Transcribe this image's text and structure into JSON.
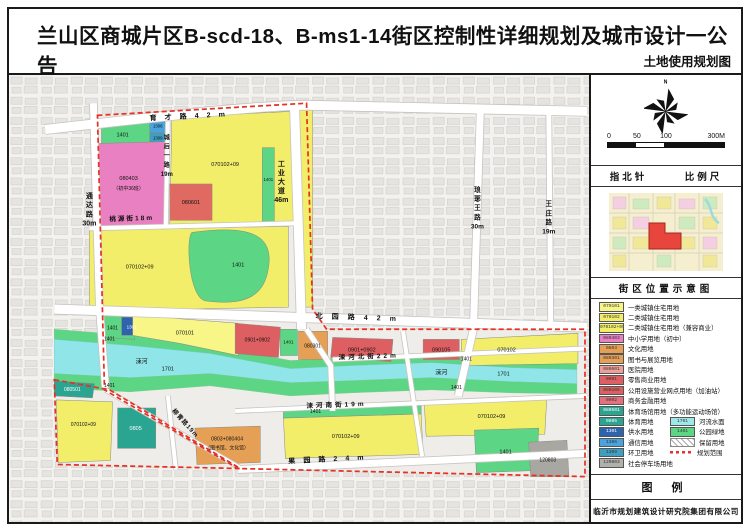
{
  "header": {
    "title": "兰山区商城片区B-scd-18、B-ms1-14街区控制性详细规划及城市设计一公告",
    "subtitle": "土地使用规划图"
  },
  "sidebar": {
    "north_label": "N",
    "scale_ticks": [
      "0",
      "50",
      "100",
      "300M"
    ],
    "captions": {
      "compass": "指北针",
      "scale": "比例尺",
      "location": "街区位置示意图",
      "legend": "图 例"
    },
    "company": "临沂市规划建筑设计研究院集团有限公司",
    "legend": {
      "single": [
        {
          "code": "070101",
          "label": "一类城镇住宅用地",
          "color": "#f8f686"
        },
        {
          "code": "070102",
          "label": "二类城镇住宅用地",
          "color": "#f2ee6a"
        },
        {
          "code": "070102+09",
          "label": "二类城镇住宅用地（兼容商业）",
          "color": "#f2ee6a"
        },
        {
          "code": "080403",
          "label": "中小学用地（初中）",
          "color": "#e980c1"
        },
        {
          "code": "0803",
          "label": "文化用地",
          "color": "#e5a055"
        },
        {
          "code": "080301",
          "label": "图书与展览用地",
          "color": "#e5a055"
        },
        {
          "code": "080601",
          "label": "医院用地",
          "color": "#eda09a"
        },
        {
          "code": "0901",
          "label": "零售商业用地",
          "color": "#dd5f62"
        },
        {
          "code": "090105",
          "label": "公用设施营业网点用地（加油站）",
          "color": "#dd5f62"
        },
        {
          "code": "0902",
          "label": "商务金融用地",
          "color": "#e4707d"
        },
        {
          "code": "080501",
          "label": "体育场馆用地（多功能运动场馆）",
          "color": "#2aa592"
        }
      ],
      "left_col": [
        {
          "code": "0805",
          "label": "体育用地",
          "color": "#2aa592"
        },
        {
          "code": "1301",
          "label": "供水用地",
          "color": "#2f64ad"
        },
        {
          "code": "1306",
          "label": "通信用地",
          "color": "#4aa3dc"
        },
        {
          "code": "1309",
          "label": "环卫用地",
          "color": "#3f9fc0"
        }
      ],
      "right_col": [
        {
          "code": "1701",
          "label": "河流水面",
          "color": "#9fe8ea"
        },
        {
          "code": "1401",
          "label": "公园绿地",
          "color": "#5cd584"
        },
        {
          "code": "",
          "label": "保留用地",
          "type": "hatch"
        },
        {
          "code": "",
          "label": "规划范围",
          "type": "boundary"
        }
      ],
      "last": {
        "code": "120803",
        "label": "社会停车场用地",
        "color": "#b2b0ab"
      }
    }
  },
  "map": {
    "labels": [
      {
        "text": "育才路42m"
      },
      {
        "text": "通达路30m"
      },
      {
        "text": "城后一路19m"
      },
      {
        "text": "桃源街18m"
      },
      {
        "text": "工业大道46m"
      },
      {
        "text": "琅琊王路30m"
      },
      {
        "text": "王庄路19m"
      },
      {
        "text": "北园路42m"
      },
      {
        "text": "涑河北街22m"
      },
      {
        "text": "涑河南街19m"
      },
      {
        "text": "果园路24m"
      },
      {
        "text": "柳青路19m"
      },
      {
        "text": "1401"
      },
      {
        "text": "1306"
      },
      {
        "text": "1309"
      },
      {
        "text": "080403"
      },
      {
        "text": "（初中36班）"
      },
      {
        "text": "070102+09"
      },
      {
        "text": "080601"
      },
      {
        "text": "070102+09"
      },
      {
        "text": "1401"
      },
      {
        "text": "1401"
      },
      {
        "text": "1401"
      },
      {
        "text": "1301"
      },
      {
        "text": "070101"
      },
      {
        "text": "0901+0902"
      },
      {
        "text": "1401"
      },
      {
        "text": "080301"
      },
      {
        "text": "0901+0902"
      },
      {
        "text": "090105"
      },
      {
        "text": "070102"
      },
      {
        "text": "涑河"
      },
      {
        "text": "1701"
      },
      {
        "text": "1401"
      },
      {
        "text": "1401"
      },
      {
        "text": "涑河"
      },
      {
        "text": "1701"
      },
      {
        "text": "1401"
      },
      {
        "text": "1401"
      },
      {
        "text": "1401"
      },
      {
        "text": "080501"
      },
      {
        "text": "070102+09"
      },
      {
        "text": "0805"
      },
      {
        "text": "0803+080404"
      },
      {
        "text": "（图书馆、文化馆）"
      },
      {
        "text": "070102+09"
      },
      {
        "text": "070102+09"
      },
      {
        "text": "1401"
      },
      {
        "text": "120803"
      }
    ]
  },
  "colors": {
    "yellow": "#f2ee6a",
    "yellow-light": "#f8f686",
    "pink": "#e980c1",
    "red": "#dd5f62",
    "salmon": "#e06a62",
    "orange": "#e5a055",
    "green": "#5cd584",
    "cyan": "#8fe5e7",
    "teal": "#2aa592",
    "blue-dark": "#2f64ad",
    "blue": "#4aa3dc",
    "blue2": "#3f9fc0",
    "gray-parcel": "#a9a7a2",
    "boundary": "#e53126",
    "bg": "#f3f2ef",
    "block": "#e6e4e0",
    "blockline": "#d2d0cb",
    "planbase": "#efede9",
    "roadline": "#c6c4bf"
  }
}
